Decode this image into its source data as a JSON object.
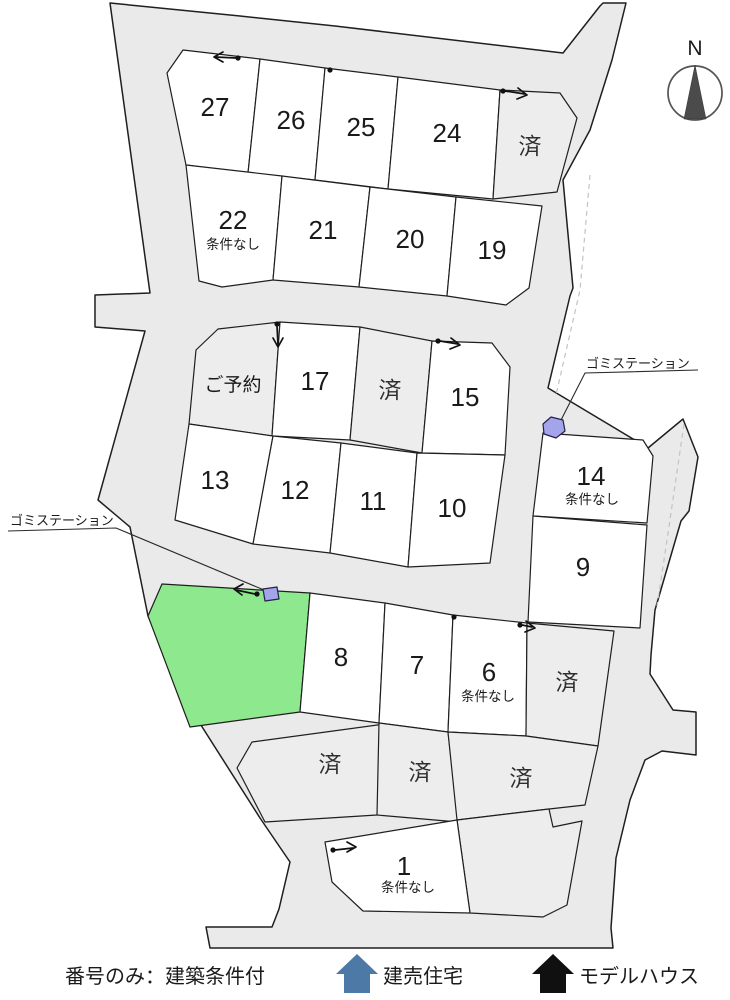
{
  "compass": {
    "label": "N"
  },
  "garbage_stations": [
    {
      "label": "ゴミステーション"
    },
    {
      "label": "ゴミステーション"
    }
  ],
  "legend": {
    "rule": "番号のみ：建築条件付",
    "blue_house": "建売住宅",
    "black_house": "モデルハウス"
  },
  "lots": [
    {
      "id": "27",
      "label": "27",
      "sublabel": "",
      "status": "available"
    },
    {
      "id": "26",
      "label": "26",
      "sublabel": "",
      "status": "available"
    },
    {
      "id": "25",
      "label": "25",
      "sublabel": "",
      "status": "available"
    },
    {
      "id": "24",
      "label": "24",
      "sublabel": "",
      "status": "available"
    },
    {
      "id": "sold-top",
      "label": "済",
      "sublabel": "",
      "status": "sold"
    },
    {
      "id": "22",
      "label": "22",
      "sublabel": "条件なし",
      "status": "available"
    },
    {
      "id": "21",
      "label": "21",
      "sublabel": "",
      "status": "available"
    },
    {
      "id": "20",
      "label": "20",
      "sublabel": "",
      "status": "available"
    },
    {
      "id": "19",
      "label": "19",
      "sublabel": "",
      "status": "available"
    },
    {
      "id": "reserved",
      "label": "ご予約",
      "sublabel": "",
      "status": "reserved"
    },
    {
      "id": "17",
      "label": "17",
      "sublabel": "",
      "status": "available"
    },
    {
      "id": "sold-mid",
      "label": "済",
      "sublabel": "",
      "status": "sold"
    },
    {
      "id": "15",
      "label": "15",
      "sublabel": "",
      "status": "available"
    },
    {
      "id": "13",
      "label": "13",
      "sublabel": "",
      "status": "available"
    },
    {
      "id": "12",
      "label": "12",
      "sublabel": "",
      "status": "available"
    },
    {
      "id": "11",
      "label": "11",
      "sublabel": "",
      "status": "available"
    },
    {
      "id": "10",
      "label": "10",
      "sublabel": "",
      "status": "available"
    },
    {
      "id": "14",
      "label": "14",
      "sublabel": "条件なし",
      "status": "available"
    },
    {
      "id": "9",
      "label": "9",
      "sublabel": "",
      "status": "available"
    },
    {
      "id": "green-lot",
      "label": "",
      "sublabel": "",
      "status": "green"
    },
    {
      "id": "8",
      "label": "8",
      "sublabel": "",
      "status": "available"
    },
    {
      "id": "7",
      "label": "7",
      "sublabel": "",
      "status": "available"
    },
    {
      "id": "6",
      "label": "6",
      "sublabel": "条件なし",
      "status": "available"
    },
    {
      "id": "sold-right",
      "label": "済",
      "sublabel": "",
      "status": "sold"
    },
    {
      "id": "sold-a",
      "label": "済",
      "sublabel": "",
      "status": "sold"
    },
    {
      "id": "sold-b",
      "label": "済",
      "sublabel": "",
      "status": "sold"
    },
    {
      "id": "sold-c",
      "label": "済",
      "sublabel": "",
      "status": "sold"
    },
    {
      "id": "gray-lot",
      "label": "",
      "sublabel": "",
      "status": "gray"
    },
    {
      "id": "1",
      "label": "1",
      "sublabel": "条件なし",
      "status": "available"
    }
  ],
  "colors": {
    "road": "#eaeaea",
    "sold_lot": "#ededed",
    "green_lot": "#8ee88e",
    "marker_blue": "#a4a4ea",
    "legend_blue": "#4d79a7",
    "legend_black": "#101010"
  }
}
